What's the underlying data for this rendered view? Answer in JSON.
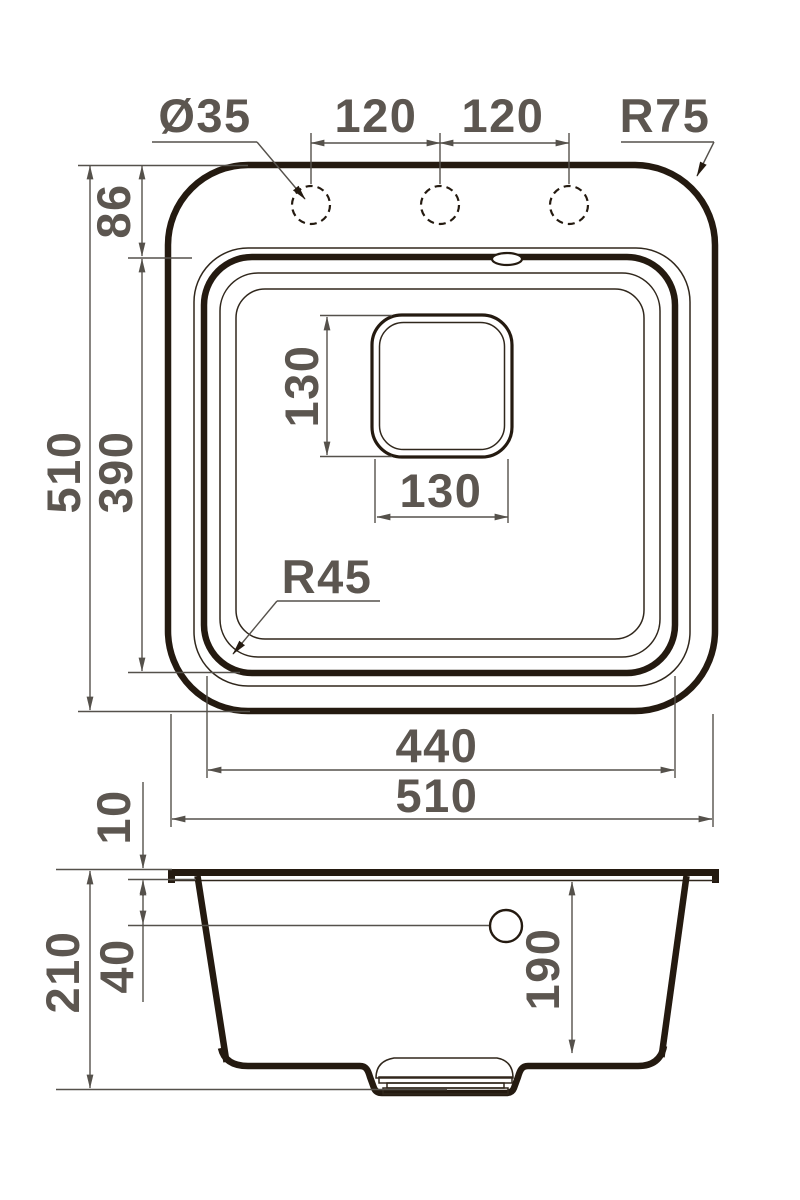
{
  "drawing": {
    "type": "sink-dimension-diagram",
    "colors": {
      "outline": "#241a10",
      "thin_line": "#30271c",
      "dimension_line": "#55514b",
      "dimension_text": "#5c5650",
      "background": "#ffffff"
    },
    "top_view": {
      "labels": {
        "hole_diameter": "Ø35",
        "hole_spacing_1": "120",
        "hole_spacing_2": "120",
        "outer_corner_radius": "R75",
        "top_ledge_depth": "86",
        "overall_depth": "510",
        "bowl_depth": "390",
        "drain_size_vertical": "130",
        "drain_size_horizontal": "130",
        "bowl_corner_radius": "R45",
        "bowl_width": "440",
        "overall_width": "510"
      }
    },
    "side_view": {
      "labels": {
        "rim_height": "10",
        "overflow_offset": "40",
        "overall_height": "210",
        "bowl_inner_depth": "190"
      }
    }
  }
}
